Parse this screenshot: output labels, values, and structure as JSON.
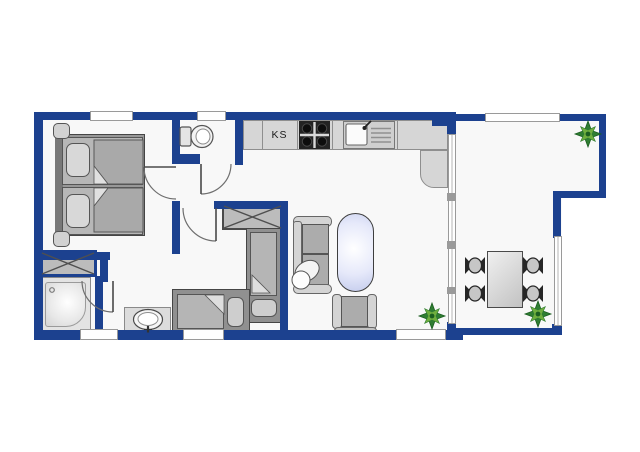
{
  "plan": {
    "type": "apartment-floor-plan",
    "label_ks": "KS"
  },
  "palette": {
    "wall": "#1c418f",
    "floor": "#f8f8f8",
    "counter": "#d6d6d6",
    "counterEdge": "#8e8e8e",
    "furnLight": "#d4d4d4",
    "furnMid": "#b2b2b2",
    "furnDark": "#909090",
    "stove": "#232323",
    "tableTint": "#e6e9fa",
    "plantDark": "#2f7d32",
    "plantLight": "#6fae3e",
    "windowFrame": "#9a9a9a"
  },
  "rooms": [
    "bedroom",
    "wc",
    "hallway",
    "second-bedroom",
    "shower-room",
    "kitchen",
    "living-room",
    "terrace"
  ],
  "furniture": {
    "bedroom": [
      "double-bed",
      "nightstand",
      "nightstand",
      "wardrobe"
    ],
    "wc": [
      "toilet"
    ],
    "kitchen": [
      "fridge-KS",
      "stove",
      "sink",
      "counter"
    ],
    "second-bedroom": [
      "wardrobe",
      "single-bed",
      "single-bed"
    ],
    "shower-room": [
      "shower"
    ],
    "hallway": [
      "washbasin"
    ],
    "living-room": [
      "sofa",
      "coffee-table",
      "armchair",
      "plant"
    ],
    "terrace": [
      "dining-table",
      "stool",
      "stool",
      "stool",
      "stool",
      "plant",
      "plant"
    ]
  }
}
